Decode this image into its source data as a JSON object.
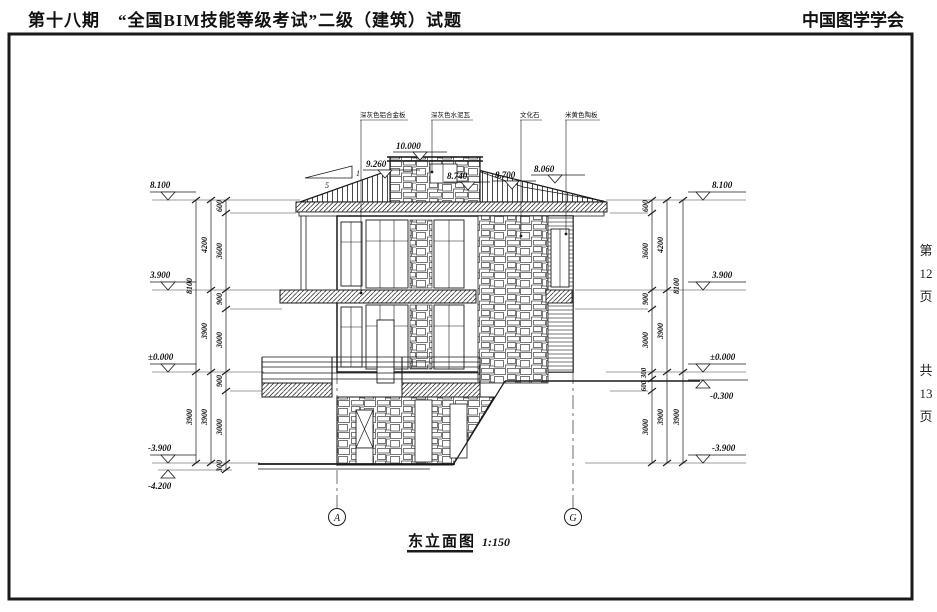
{
  "header": {
    "left": "第十八期　“全国BIM技能等级考试”二级（建筑）试题",
    "right": "中国图学学会"
  },
  "margin": {
    "page": [
      "第",
      "12",
      "页"
    ],
    "total": [
      "共",
      "13",
      "页"
    ]
  },
  "title": {
    "name": "东立面图",
    "scale": "1:150"
  },
  "materials": [
    "深灰色铝合金板",
    "深灰色水泥瓦",
    "文化石",
    "米黄色陶板"
  ],
  "slope": {
    "rise": "1",
    "run": "5"
  },
  "grids": [
    "A",
    "G"
  ],
  "levels": {
    "top": [
      "10.000",
      "9.260",
      "8.740",
      "8.700",
      "8.060"
    ],
    "left": [
      "8.100",
      "3.900",
      "±0.000",
      "-3.900",
      "-4.200"
    ],
    "right": [
      "8.100",
      "3.900",
      "±0.000",
      "-0.300",
      "-3.900"
    ]
  },
  "dims": {
    "left_inner": [
      "600",
      "3600",
      "900",
      "3000",
      "900",
      "3000",
      "300"
    ],
    "left_middle": [
      "4200",
      "3900",
      "3900"
    ],
    "left_outer": [
      "8100",
      "3900"
    ],
    "right_inner": [
      "600",
      "3600",
      "900",
      "3000",
      "300",
      "600",
      "3000"
    ],
    "right_middle": [
      "4200",
      "3900",
      "3900"
    ],
    "right_outer": [
      "8100",
      "3900"
    ]
  },
  "colors": {
    "line": "#1a1a1a",
    "bg": "#ffffff"
  }
}
